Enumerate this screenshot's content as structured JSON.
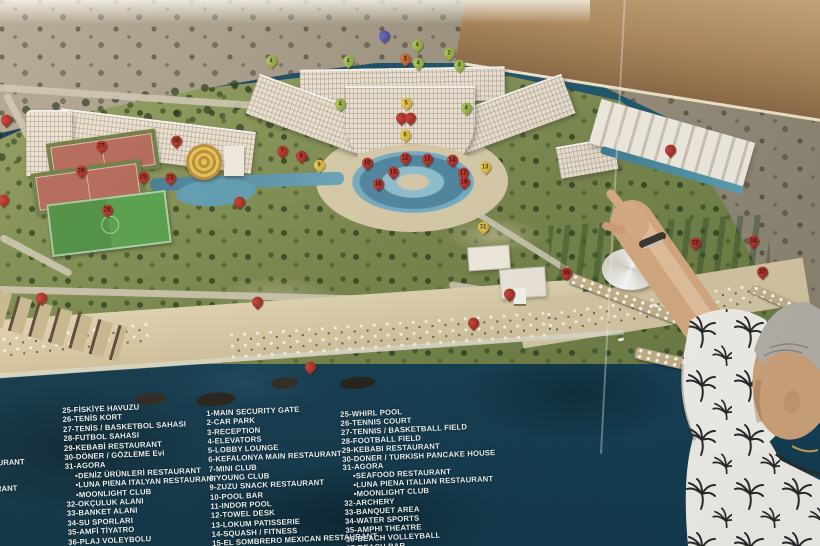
{
  "legend": {
    "columns": [
      {
        "id": "turkish",
        "items": [
          "25-FİSKİYE HAVUZU",
          "26-TENİS KORT",
          "27-TENİS / BASKETBOL SAHASI",
          "28-FUTBOL SAHASI",
          "29-KEBABİ RESTAURANT",
          "30-DÖNER / GÖZLEME Evi",
          "31-AGORA",
          "•DENİZ ÜRÜNLERİ RESTAURANT",
          "•LUNA PIENA ITALYAN RESTAURANT",
          "•MOONLIGHT CLUB",
          "32-OKÇULUK ALANI",
          "33-BANKET ALANI",
          "34-SU SPORLARI",
          "35-AMFİ TİYATRO",
          "36-PLAJ VOLEYBOLU"
        ]
      },
      {
        "id": "facilities",
        "items": [
          "1-MAIN SECURITY GATE",
          "2-CAR PARK",
          "3-RECEPTION",
          "4-ELEVATORS",
          "5-LOBBY LOUNGE",
          "6-KEFALONYA MAIN RESTAURANT",
          "7-MINI CLUB",
          "8-YOUNG CLUB",
          "9-ZUZU SNACK RESTAURANT",
          "10-POOL BAR",
          "11-INDOR POOL",
          "12-TOWEL DESK",
          "13-LOKUM PATISSERIE",
          "14-SQUASH / FITNESS",
          "15-EL SOMBRERO MEXICAN RESTAURANT"
        ]
      },
      {
        "id": "english",
        "items": [
          "25-WHIRL POOL",
          "26-TENNIS COURT",
          "27-TENNIS / BASKETBALL FIELD",
          "28-FOOTBALL FIELD",
          "29-KEBABI RESTAURANT",
          "30-DONER / TURKISH PANCAKE HOUSE",
          "31-AGORA",
          "•SEAFOOD RESTAURANT",
          "•LUNA PIENA ITALIAN RESTAURANT",
          "•MOONLIGHT CLUB",
          "32-ARCHERY",
          "33-BANQUET AREA",
          "34-WATER SPORTS",
          "35-AMPHI THEATRE",
          "36-BEACH VOLLEYBALL",
          "37-BEACH BAR"
        ]
      }
    ],
    "edge_fragments": [
      {
        "text": "TAURANT",
        "x": -12,
        "y": 458
      },
      {
        "text": "RANT",
        "x": -4,
        "y": 484
      }
    ]
  },
  "pins": [
    {
      "label": "",
      "color": "blue",
      "x": 384,
      "y": 46
    },
    {
      "label": "4",
      "color": "green",
      "x": 271,
      "y": 71
    },
    {
      "label": "4",
      "color": "green",
      "x": 348,
      "y": 71
    },
    {
      "label": "4",
      "color": "green",
      "x": 417,
      "y": 55
    },
    {
      "label": "3",
      "color": "orange",
      "x": 405,
      "y": 69
    },
    {
      "label": "4",
      "color": "green",
      "x": 418,
      "y": 73
    },
    {
      "label": "2",
      "color": "green",
      "x": 449,
      "y": 63
    },
    {
      "label": "4",
      "color": "green",
      "x": 459,
      "y": 75
    },
    {
      "label": "4",
      "color": "green",
      "x": 340,
      "y": 114
    },
    {
      "label": "5",
      "color": "yellow",
      "x": 406,
      "y": 113
    },
    {
      "label": "4",
      "color": "green",
      "x": 466,
      "y": 118
    },
    {
      "label": "",
      "color": "red",
      "x": 401,
      "y": 128
    },
    {
      "label": "",
      "color": "red",
      "x": 410,
      "y": 128
    },
    {
      "label": "6",
      "color": "yellow",
      "x": 405,
      "y": 145
    },
    {
      "label": "7",
      "color": "red",
      "x": 282,
      "y": 161
    },
    {
      "label": "8",
      "color": "red",
      "x": 301,
      "y": 166
    },
    {
      "label": "9",
      "color": "yellow",
      "x": 319,
      "y": 175
    },
    {
      "label": "10",
      "color": "red",
      "x": 367,
      "y": 173
    },
    {
      "label": "11",
      "color": "red",
      "x": 405,
      "y": 168
    },
    {
      "label": "12",
      "color": "red",
      "x": 427,
      "y": 169
    },
    {
      "label": "14",
      "color": "red",
      "x": 452,
      "y": 170
    },
    {
      "label": "15",
      "color": "red",
      "x": 393,
      "y": 182
    },
    {
      "label": "16",
      "color": "red",
      "x": 378,
      "y": 194
    },
    {
      "label": "17",
      "color": "red",
      "x": 463,
      "y": 183
    },
    {
      "label": "18",
      "color": "red",
      "x": 464,
      "y": 192
    },
    {
      "label": "13",
      "color": "yellow",
      "x": 485,
      "y": 177
    },
    {
      "label": "31",
      "color": "yellow",
      "x": 483,
      "y": 237
    },
    {
      "label": "",
      "color": "red",
      "x": 6,
      "y": 130
    },
    {
      "label": "27",
      "color": "red",
      "x": 101,
      "y": 156
    },
    {
      "label": "26",
      "color": "red",
      "x": 81,
      "y": 181
    },
    {
      "label": "28",
      "color": "red",
      "x": 107,
      "y": 220
    },
    {
      "label": "25",
      "color": "red",
      "x": 143,
      "y": 187
    },
    {
      "label": "23",
      "color": "red",
      "x": 170,
      "y": 188
    },
    {
      "label": "30",
      "color": "red",
      "x": 176,
      "y": 151
    },
    {
      "label": "",
      "color": "red",
      "x": 3,
      "y": 210
    },
    {
      "label": "",
      "color": "red",
      "x": 239,
      "y": 212
    },
    {
      "label": "",
      "color": "red",
      "x": 670,
      "y": 160
    },
    {
      "label": "35",
      "color": "red",
      "x": 635,
      "y": 260
    },
    {
      "label": "32",
      "color": "red",
      "x": 695,
      "y": 253
    },
    {
      "label": "34",
      "color": "red",
      "x": 753,
      "y": 251
    },
    {
      "label": "37",
      "color": "red",
      "x": 762,
      "y": 282
    },
    {
      "label": "36",
      "color": "red",
      "x": 566,
      "y": 283
    },
    {
      "label": "",
      "color": "red",
      "x": 41,
      "y": 308
    },
    {
      "label": "",
      "color": "red",
      "x": 257,
      "y": 312
    },
    {
      "label": "",
      "color": "red",
      "x": 310,
      "y": 377
    },
    {
      "label": "",
      "color": "red",
      "x": 473,
      "y": 333
    },
    {
      "label": "",
      "color": "red",
      "x": 509,
      "y": 304
    }
  ],
  "pin_colors": {
    "red": "#a8291f",
    "yellow": "#e3c83d",
    "green": "#9fb648",
    "orange": "#c06233",
    "blue": "#5053a8"
  },
  "scene_colors": {
    "sea": "#17465c",
    "sand": "#d8c8a4",
    "grass": "#77854a",
    "hill": "#9b917d"
  }
}
